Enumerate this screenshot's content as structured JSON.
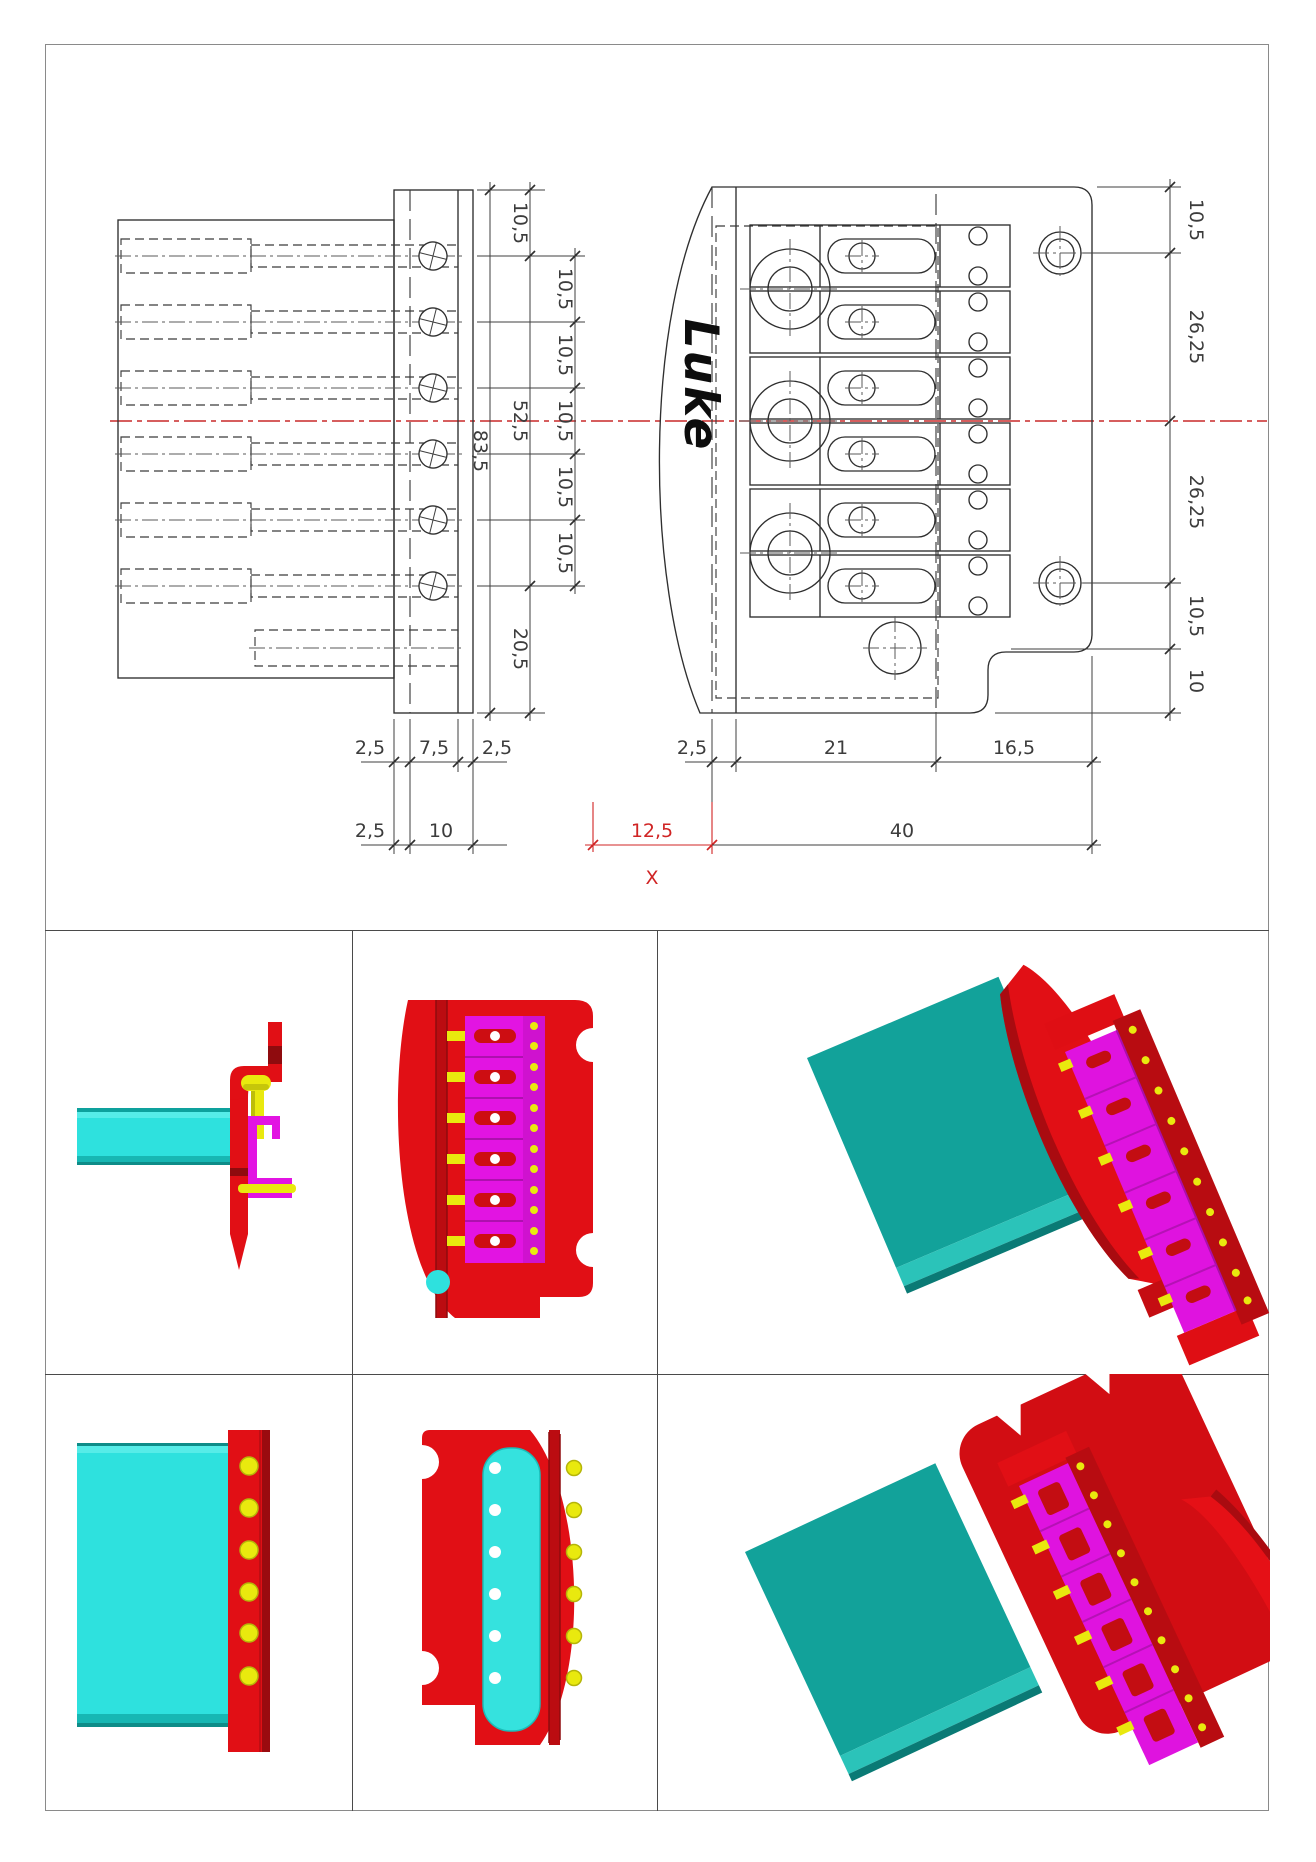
{
  "drawing": {
    "logo": "Luke",
    "dims": {
      "plate_top_gap": "10,5",
      "pin_pitch": [
        "10,5",
        "10,5",
        "10,5",
        "10,5",
        "10,5"
      ],
      "pins_span": "52,5",
      "total_height": "83,5",
      "bottom_gap": "20,5",
      "plate_row1": [
        "2,5",
        "7,5",
        "2,5"
      ],
      "plate_row2": [
        "2,5",
        "10"
      ],
      "right_side": [
        "10,5",
        "26,25",
        "26,25",
        "10,5",
        "10"
      ],
      "right_row1": [
        "2,5",
        "21",
        "16,5"
      ],
      "offset_red": "12,5",
      "total_width": "40",
      "datum": "X"
    },
    "colors": {
      "part_red": "#e10f15",
      "magenta": "#e214e2",
      "cyan": "#2ee1de",
      "teal": "#12a29a",
      "yellow": "#e9e90e",
      "centerline_red": "#c92828",
      "dimension_red": "#d02424",
      "line": "#2f2f2f"
    }
  }
}
